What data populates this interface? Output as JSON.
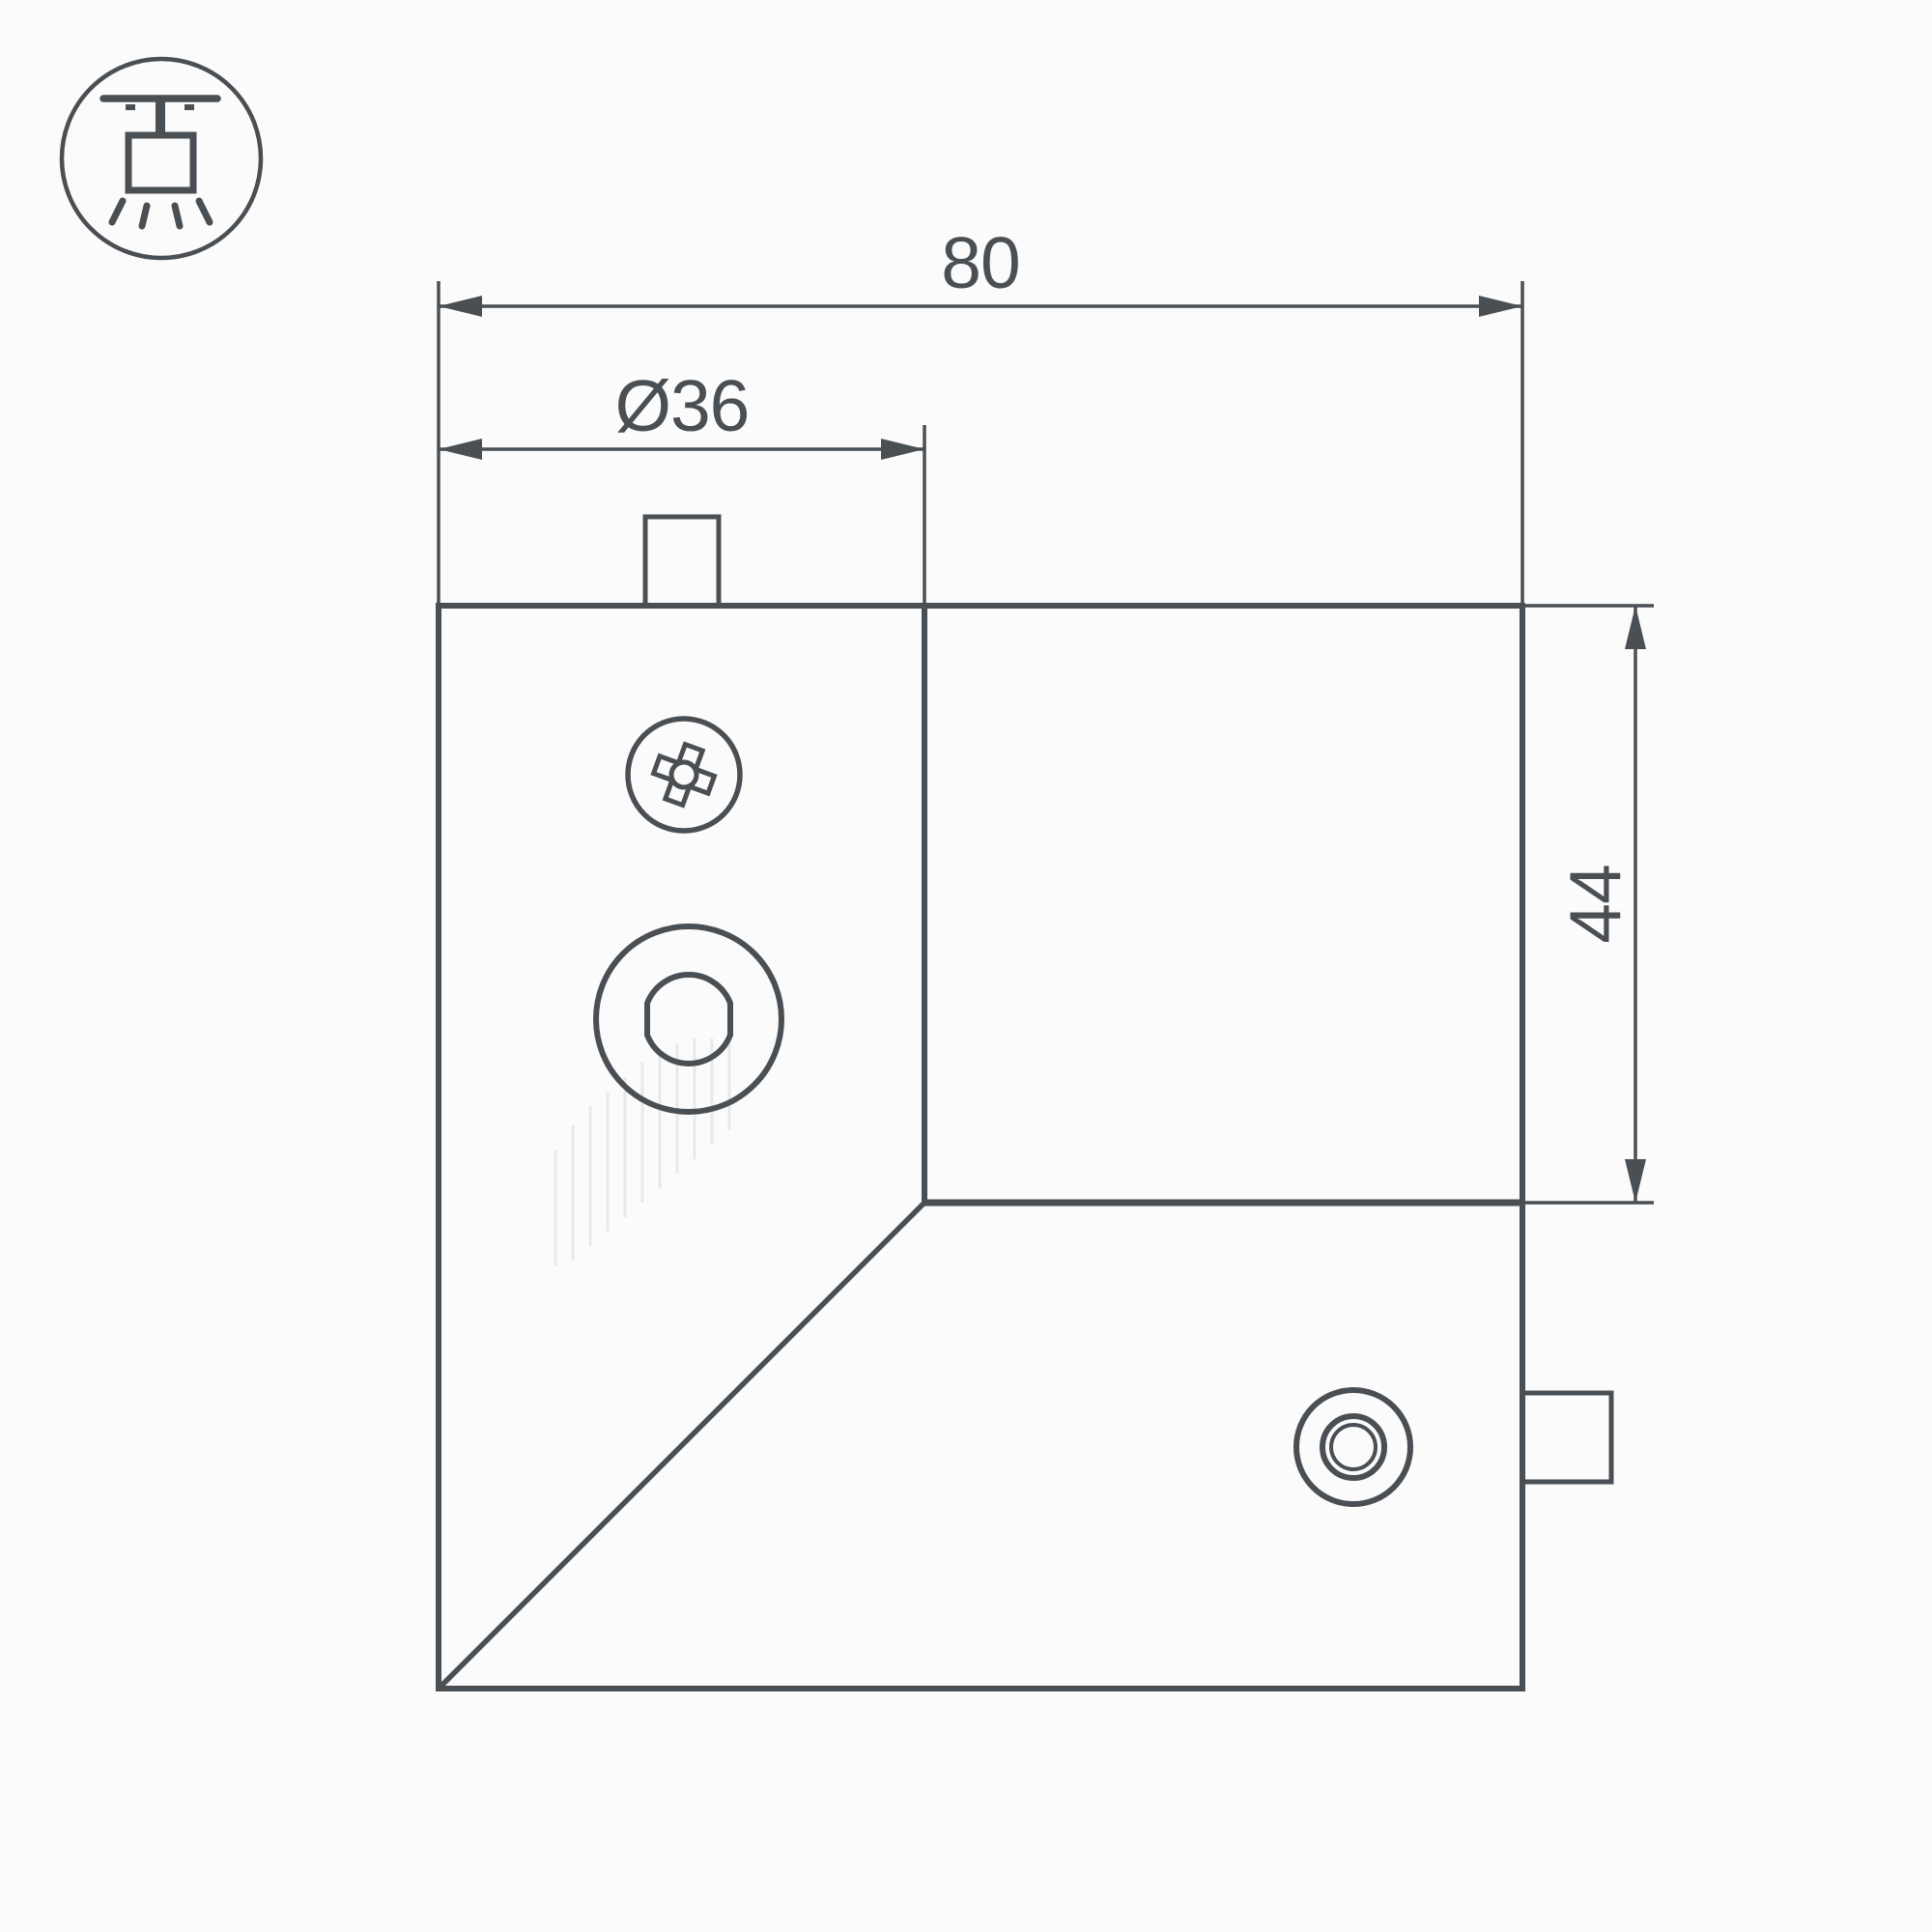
{
  "icon": {
    "name": "ceiling-mounted-track-light"
  },
  "dimensions": {
    "width": "80",
    "diameter": "Ø36",
    "height": "44"
  },
  "theme": {
    "line_color": "#4a4f54",
    "background": "#fbfbfc",
    "faint_line": "#e7e9ea"
  }
}
